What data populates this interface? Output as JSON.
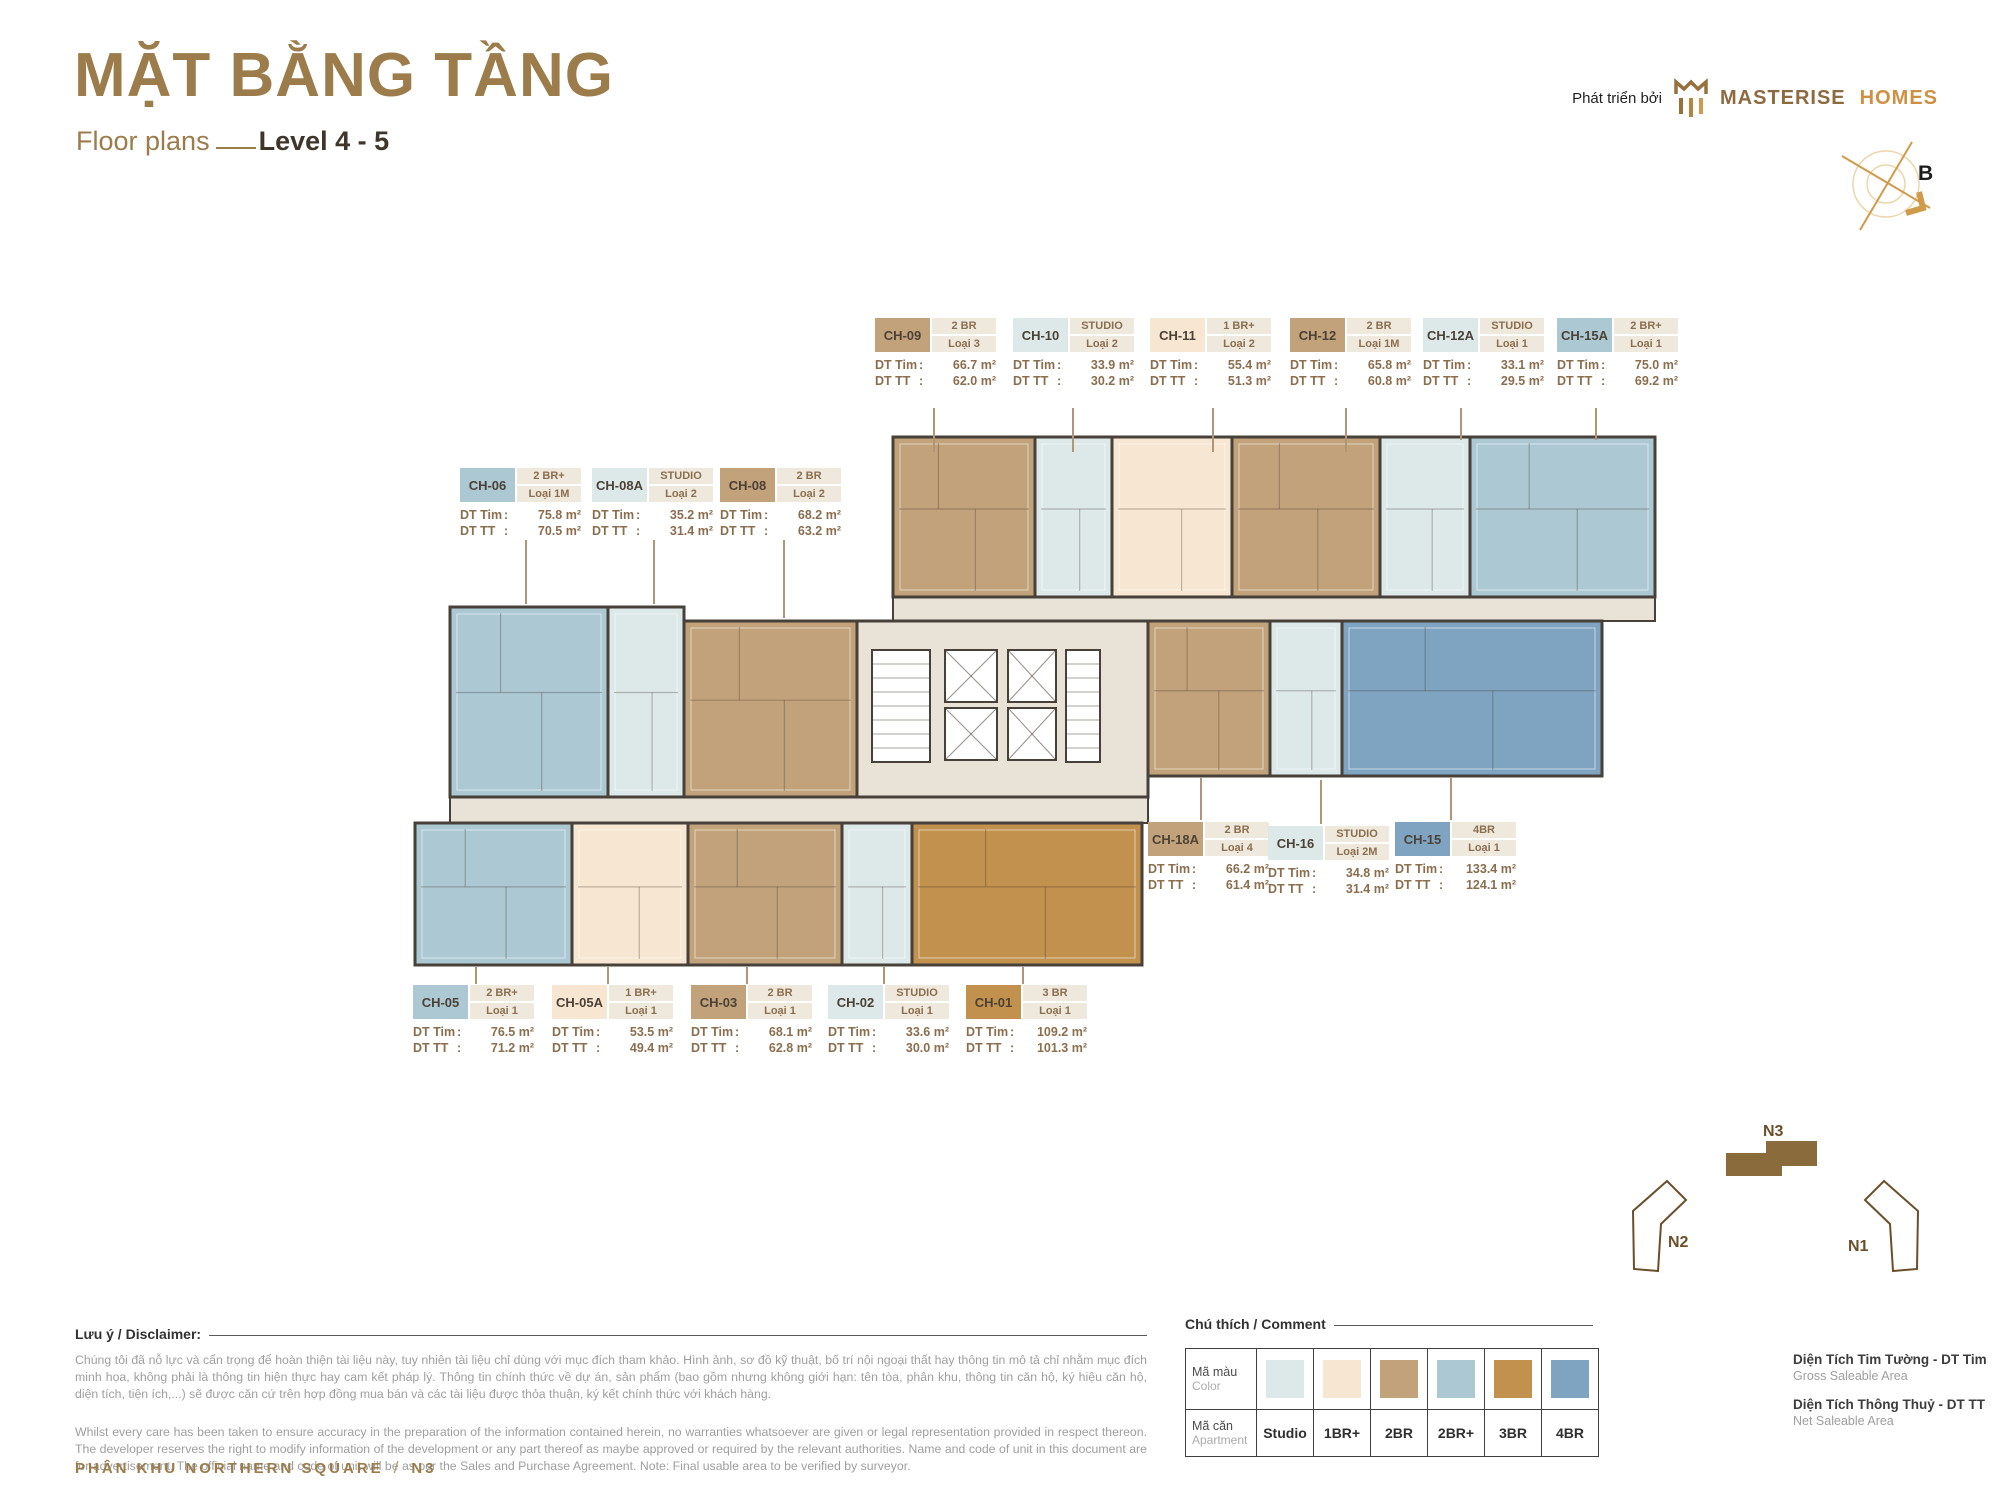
{
  "page": {
    "title": "MẶT BẰNG TẦNG",
    "subtitle": "Floor plans",
    "level": "Level 4 - 5",
    "developer_prefix": "Phát triển bởi",
    "brand_primary": "MASTERISE",
    "brand_secondary": "HOMES",
    "compass_label": "B",
    "footer_zone": "PHÂN KHU NORTHERN SQUARE",
    "footer_sep": "/",
    "footer_block": "N3"
  },
  "labels": {
    "dt_tim": "DT Tim",
    "dt_tt": "DT TT"
  },
  "units": [
    {
      "code": "CH-09",
      "type": "2 BR",
      "variant": "Loại 3",
      "dt_tim": "66.7 m²",
      "dt_tt": "62.0 m²",
      "type_key": "2br"
    },
    {
      "code": "CH-10",
      "type": "STUDIO",
      "variant": "Loại 2",
      "dt_tim": "33.9 m²",
      "dt_tt": "30.2 m²",
      "type_key": "studio"
    },
    {
      "code": "CH-11",
      "type": "1 BR+",
      "variant": "Loại 2",
      "dt_tim": "55.4 m²",
      "dt_tt": "51.3 m²",
      "type_key": "1brp"
    },
    {
      "code": "CH-12",
      "type": "2 BR",
      "variant": "Loại 1M",
      "dt_tim": "65.8 m²",
      "dt_tt": "60.8 m²",
      "type_key": "2br"
    },
    {
      "code": "CH-12A",
      "type": "STUDIO",
      "variant": "Loại 1",
      "dt_tim": "33.1 m²",
      "dt_tt": "29.5 m²",
      "type_key": "studio"
    },
    {
      "code": "CH-15A",
      "type": "2 BR+",
      "variant": "Loại 1",
      "dt_tim": "75.0 m²",
      "dt_tt": "69.2 m²",
      "type_key": "2brp"
    },
    {
      "code": "CH-06",
      "type": "2 BR+",
      "variant": "Loại 1M",
      "dt_tim": "75.8 m²",
      "dt_tt": "70.5 m²",
      "type_key": "2brp"
    },
    {
      "code": "CH-08A",
      "type": "STUDIO",
      "variant": "Loại 2",
      "dt_tim": "35.2 m²",
      "dt_tt": "31.4 m²",
      "type_key": "studio"
    },
    {
      "code": "CH-08",
      "type": "2 BR",
      "variant": "Loại 2",
      "dt_tim": "68.2 m²",
      "dt_tt": "63.2 m²",
      "type_key": "2br"
    },
    {
      "code": "CH-18A",
      "type": "2 BR",
      "variant": "Loại 4",
      "dt_tim": "66.2 m²",
      "dt_tt": "61.4 m²",
      "type_key": "2br"
    },
    {
      "code": "CH-16",
      "type": "STUDIO",
      "variant": "Loại 2M",
      "dt_tim": "34.8 m²",
      "dt_tt": "31.4 m²",
      "type_key": "studio"
    },
    {
      "code": "CH-15",
      "type": "4BR",
      "variant": "Loại 1",
      "dt_tim": "133.4 m²",
      "dt_tt": "124.1 m²",
      "type_key": "4br"
    },
    {
      "code": "CH-05",
      "type": "2 BR+",
      "variant": "Loại 1",
      "dt_tim": "76.5 m²",
      "dt_tt": "71.2 m²",
      "type_key": "2brp"
    },
    {
      "code": "CH-05A",
      "type": "1 BR+",
      "variant": "Loại 1",
      "dt_tim": "53.5 m²",
      "dt_tt": "49.4 m²",
      "type_key": "1brp"
    },
    {
      "code": "CH-03",
      "type": "2 BR",
      "variant": "Loại 1",
      "dt_tim": "68.1 m²",
      "dt_tt": "62.8 m²",
      "type_key": "2br"
    },
    {
      "code": "CH-02",
      "type": "STUDIO",
      "variant": "Loại 1",
      "dt_tim": "33.6 m²",
      "dt_tt": "30.0 m²",
      "type_key": "studio"
    },
    {
      "code": "CH-01",
      "type": "3 BR",
      "variant": "Loại 1",
      "dt_tim": "109.2 m²",
      "dt_tt": "101.3 m²",
      "type_key": "3br"
    }
  ],
  "legend": {
    "heading": "Chú thích / Comment",
    "color_row_label": "Mã màu",
    "color_row_sub": "Color",
    "apartment_row_label": "Mã căn",
    "apartment_row_sub": "Apartment",
    "items": [
      {
        "key": "studio",
        "label": "Studio",
        "color": "#dde9e9"
      },
      {
        "key": "1brp",
        "label": "1BR+",
        "color": "#f7e6d1"
      },
      {
        "key": "2br",
        "label": "2BR",
        "color": "#c2a27a"
      },
      {
        "key": "2brp",
        "label": "2BR+",
        "color": "#abc8d3"
      },
      {
        "key": "3br",
        "label": "3BR",
        "color": "#c2914e"
      },
      {
        "key": "4br",
        "label": "4BR",
        "color": "#7fa4c2"
      }
    ]
  },
  "area_definitions": [
    {
      "vi": "Diện Tích Tim Tường - DT Tim",
      "en": "Gross Saleable Area"
    },
    {
      "vi": "Diện Tích Thông Thuỷ - DT TT",
      "en": "Net Saleable Area"
    }
  ],
  "disclaimer": {
    "heading": "Lưu ý / Disclaimer:",
    "vi": "Chúng tôi đã nỗ lực và cẩn trọng để hoàn thiện tài liệu này, tuy nhiên tài liệu chỉ dùng với mục đích tham khảo. Hình ảnh, sơ đồ kỹ thuật, bố trí nội ngoại thất hay thông tin mô tả chỉ nhằm mục đích minh họa, không phải là thông tin hiện thực hay cam kết pháp lý. Thông tin chính thức về dự án, sản phẩm (bao gồm nhưng không giới hạn: tên tòa, phân khu, thông tin căn hộ, ký hiệu căn hộ, diện tích, tiện ích,...) sẽ được căn cứ trên hợp đồng mua bán và các tài liệu được thỏa thuận, ký kết chính thức với khách hàng.",
    "en": "Whilst every care has been taken to ensure accuracy in the preparation of the information contained herein, no warranties whatsoever are given or legal representation provided in respect thereon. The developer reserves the right to modify information of the development or any part thereof as maybe approved or required by the relevant authorities. Name and code of unit in this document are for advertisement. The official name and code of unit will be as per the Sales and Purchase Agreement. Note: Final usable area to be verified by surveyor."
  },
  "siteplan": {
    "blocks": [
      "N1",
      "N2",
      "N3"
    ],
    "highlighted": "N3"
  },
  "colors": {
    "accent_gold": "#9b7c4a",
    "text_brown": "#8a6e4e",
    "chip_beige": "#efe9dd",
    "wall": "#474139",
    "corridor": "#e9e2d6",
    "siteplan_fill": "#8a6c3c"
  }
}
